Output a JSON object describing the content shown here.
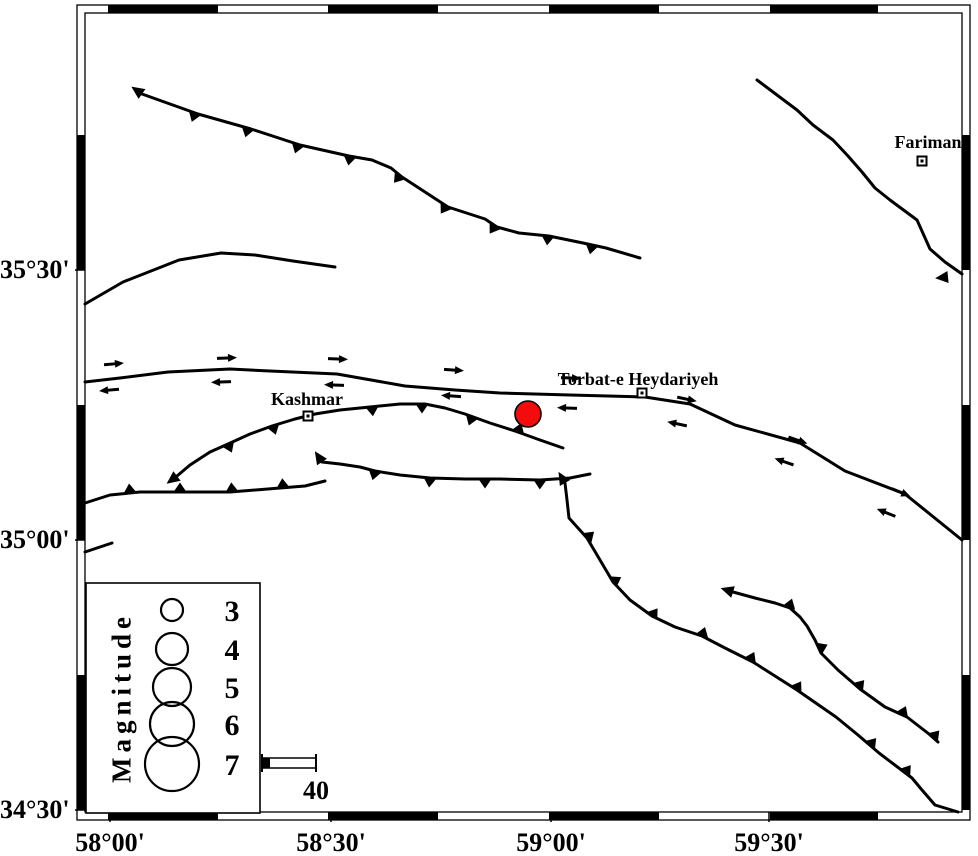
{
  "figure": {
    "type": "seismotectonic-map",
    "region": {
      "lon_min": "58°00'",
      "lon_max": "59°30'",
      "lat_min": "34°30'",
      "lat_max": "35°30'"
    }
  },
  "axes": {
    "lat": [
      {
        "text": "35°30'",
        "y": 270
      },
      {
        "text": "35°00'",
        "y": 540
      },
      {
        "text": "34°30'",
        "y": 810
      }
    ],
    "lon": [
      {
        "text": "58°00'",
        "x": 110
      },
      {
        "text": "58°30'",
        "x": 331
      },
      {
        "text": "59°00'",
        "x": 551
      },
      {
        "text": "59°30'",
        "x": 769
      }
    ]
  },
  "frame": {
    "inner": [
      85,
      13,
      962,
      812
    ],
    "outer": [
      77,
      5,
      970,
      820
    ],
    "black_x": [
      [
        108,
        218
      ],
      [
        328,
        438
      ],
      [
        549,
        659
      ],
      [
        770,
        878
      ]
    ],
    "black_y": [
      [
        135,
        270
      ],
      [
        405,
        540
      ],
      [
        675,
        810
      ]
    ],
    "line_color": "#000000"
  },
  "cities": [
    {
      "name": "Kashmar",
      "marker": [
        308,
        416
      ],
      "label_center": [
        307,
        399
      ]
    },
    {
      "name": "Torbat-e Heydariyeh",
      "marker": [
        642,
        393
      ],
      "label_center": [
        638,
        379
      ]
    },
    {
      "name": "Fariman",
      "marker": [
        922,
        161
      ],
      "label_center": [
        928,
        142
      ]
    }
  ],
  "earthquake": {
    "x": 528,
    "y": 414,
    "r": 13,
    "fill": "#f40b0b",
    "stroke": "#000000"
  },
  "faults": [
    {
      "name": "north-thrust-fault",
      "points": [
        [
          142,
          94
        ],
        [
          198,
          114
        ],
        [
          251,
          129
        ],
        [
          300,
          145
        ],
        [
          349,
          156
        ],
        [
          372,
          160
        ],
        [
          391,
          168
        ],
        [
          402,
          177
        ],
        [
          425,
          192
        ],
        [
          448,
          207
        ],
        [
          485,
          219
        ],
        [
          497,
          227
        ],
        [
          519,
          233
        ],
        [
          549,
          236
        ],
        [
          583,
          243
        ],
        [
          606,
          248
        ],
        [
          640,
          258
        ]
      ],
      "barbs": [
        {
          "x": 195,
          "side": -1
        },
        {
          "x": 248,
          "side": -1
        },
        {
          "x": 298,
          "side": -1
        },
        {
          "x": 350,
          "side": -1
        },
        {
          "x": 400,
          "side": -1
        },
        {
          "x": 446,
          "side": -1
        },
        {
          "x": 495,
          "side": -1
        },
        {
          "x": 548,
          "side": -1
        },
        {
          "x": 592,
          "side": -1
        }
      ],
      "tip": {
        "x": 142,
        "y": 94,
        "dx": -0.82,
        "dy": -0.57
      }
    },
    {
      "name": "north-curve-fault",
      "points": [
        [
          85,
          304
        ],
        [
          123,
          282
        ],
        [
          179,
          260
        ],
        [
          221,
          253
        ],
        [
          255,
          255
        ],
        [
          293,
          261
        ],
        [
          335,
          267
        ]
      ],
      "barbs": []
    },
    {
      "name": "northeast-fault",
      "points": [
        [
          757,
          80
        ],
        [
          777,
          95
        ],
        [
          797,
          110
        ],
        [
          813,
          125
        ],
        [
          833,
          140
        ],
        [
          848,
          156
        ],
        [
          862,
          172
        ],
        [
          875,
          188
        ],
        [
          890,
          200
        ],
        [
          917,
          220
        ],
        [
          930,
          249
        ],
        [
          945,
          262
        ],
        [
          962,
          274
        ]
      ],
      "barbs": [],
      "tip": {
        "x": 948,
        "y": 277,
        "dx": -0.99,
        "dy": 0.1
      }
    },
    {
      "name": "main-strike-slip-fault",
      "points": [
        [
          85,
          382
        ],
        [
          120,
          378
        ],
        [
          168,
          372
        ],
        [
          230,
          369
        ],
        [
          270,
          371
        ],
        [
          337,
          374
        ],
        [
          405,
          386
        ],
        [
          455,
          390
        ],
        [
          500,
          393
        ],
        [
          570,
          395
        ],
        [
          645,
          397
        ],
        [
          690,
          404
        ],
        [
          735,
          425
        ],
        [
          800,
          443
        ],
        [
          845,
          471
        ],
        [
          905,
          494
        ],
        [
          962,
          540
        ]
      ],
      "barbs": []
    },
    {
      "name": "kashmar-thrust-fault",
      "points": [
        [
          177,
          476
        ],
        [
          190,
          465
        ],
        [
          210,
          452
        ],
        [
          228,
          444
        ],
        [
          250,
          434
        ],
        [
          272,
          426
        ],
        [
          295,
          419
        ],
        [
          315,
          414
        ],
        [
          340,
          410
        ],
        [
          370,
          407
        ],
        [
          400,
          404
        ],
        [
          425,
          404
        ],
        [
          445,
          408
        ],
        [
          465,
          414
        ],
        [
          490,
          423
        ],
        [
          515,
          431
        ],
        [
          540,
          440
        ],
        [
          563,
          448
        ]
      ],
      "barbs": [
        {
          "x": 228,
          "side": -1
        },
        {
          "x": 273,
          "side": -1
        },
        {
          "x": 372,
          "side": -1
        },
        {
          "x": 422,
          "side": -1
        },
        {
          "x": 472,
          "side": -1
        },
        {
          "x": 518,
          "side": 1
        }
      ],
      "tip": {
        "x": 177,
        "y": 476,
        "dx": -0.8,
        "dy": 0.6
      }
    },
    {
      "name": "south-thrust-west",
      "points": [
        [
          85,
          503
        ],
        [
          110,
          495
        ],
        [
          140,
          492
        ],
        [
          180,
          492
        ],
        [
          230,
          492
        ],
        [
          280,
          488
        ],
        [
          305,
          486
        ],
        [
          325,
          481
        ]
      ],
      "barbs": [
        {
          "x": 130,
          "side": 1
        },
        {
          "x": 180,
          "side": 1
        },
        {
          "x": 232,
          "side": 1
        },
        {
          "x": 283,
          "side": 1
        }
      ]
    },
    {
      "name": "south-thrust-east",
      "points": [
        [
          322,
          462
        ],
        [
          340,
          464
        ],
        [
          360,
          467
        ],
        [
          375,
          471
        ],
        [
          400,
          475
        ],
        [
          430,
          478
        ],
        [
          465,
          479
        ],
        [
          500,
          479
        ],
        [
          540,
          480
        ],
        [
          570,
          478
        ],
        [
          590,
          474
        ]
      ],
      "barbs": [
        {
          "x": 375,
          "side": -1
        },
        {
          "x": 430,
          "side": -1
        },
        {
          "x": 485,
          "side": -1
        },
        {
          "x": 540,
          "side": -1
        }
      ],
      "tip": {
        "x": 322,
        "y": 462,
        "dx": -0.55,
        "dy": -0.83
      }
    },
    {
      "name": "se-thrust-long",
      "points": [
        [
          565,
          483
        ],
        [
          567,
          500
        ],
        [
          569,
          518
        ],
        [
          587,
          538
        ],
        [
          600,
          560
        ],
        [
          613,
          582
        ],
        [
          630,
          600
        ],
        [
          652,
          616
        ],
        [
          675,
          627
        ],
        [
          702,
          636
        ],
        [
          725,
          648
        ],
        [
          753,
          662
        ],
        [
          775,
          676
        ],
        [
          797,
          690
        ],
        [
          836,
          717
        ],
        [
          858,
          735
        ],
        [
          879,
          753
        ],
        [
          912,
          778
        ],
        [
          922,
          790
        ],
        [
          935,
          805
        ],
        [
          958,
          812
        ]
      ],
      "barbs": [
        {
          "x": 587,
          "side": 1
        },
        {
          "x": 613,
          "side": 1
        },
        {
          "x": 652,
          "side": 1
        },
        {
          "x": 702,
          "side": 1
        },
        {
          "x": 750,
          "side": 1
        },
        {
          "x": 796,
          "side": 1
        },
        {
          "x": 870,
          "side": 1
        },
        {
          "x": 905,
          "side": 1
        }
      ],
      "tip": {
        "x": 565,
        "y": 483,
        "dx": -0.5,
        "dy": -0.86
      }
    },
    {
      "name": "se-thrust-short",
      "points": [
        [
          733,
          592
        ],
        [
          755,
          598
        ],
        [
          775,
          603
        ],
        [
          790,
          608
        ],
        [
          800,
          617
        ],
        [
          807,
          626
        ],
        [
          815,
          640
        ],
        [
          821,
          653
        ],
        [
          838,
          670
        ],
        [
          860,
          689
        ],
        [
          885,
          707
        ],
        [
          907,
          717
        ],
        [
          929,
          734
        ],
        [
          938,
          742
        ]
      ],
      "barbs": [
        {
          "x": 789,
          "side": 1
        },
        {
          "x": 819,
          "side": 1
        },
        {
          "x": 858,
          "side": 1
        },
        {
          "x": 902,
          "side": 1
        },
        {
          "x": 933,
          "side": 1
        }
      ],
      "tip": {
        "x": 733,
        "y": 592,
        "dx": -0.95,
        "dy": -0.3
      }
    },
    {
      "name": "left-short-segment",
      "points": [
        [
          85,
          552
        ],
        [
          112,
          543
        ]
      ],
      "barbs": []
    }
  ],
  "strike_slip_arrows": [
    {
      "xu": 113,
      "yu": 364,
      "xl": 110,
      "yl": 390,
      "tilt": -5
    },
    {
      "xu": 226,
      "yu": 358,
      "xl": 222,
      "yl": 382,
      "tilt": -2
    },
    {
      "xu": 337,
      "yu": 359,
      "xl": 335,
      "yl": 385,
      "tilt": 2
    },
    {
      "xu": 453,
      "yu": 370,
      "xl": 452,
      "yl": 396,
      "tilt": 4
    },
    {
      "xu": 570,
      "yu": 378,
      "xl": 568,
      "yl": 408,
      "tilt": 2
    },
    {
      "xu": 686,
      "yu": 399,
      "xl": 678,
      "yl": 424,
      "tilt": 12
    },
    {
      "xu": 797,
      "yu": 440,
      "xl": 785,
      "yl": 462,
      "tilt": 19
    },
    {
      "xu": 900,
      "yu": 492,
      "xl": 887,
      "yl": 513,
      "tilt": 22
    }
  ],
  "legend": {
    "title": "Magnitude",
    "box": [
      86,
      583,
      174,
      230
    ],
    "circle_cx": 172,
    "entries": [
      {
        "label": "3",
        "cy": 610,
        "r": 11
      },
      {
        "label": "4",
        "cy": 649,
        "r": 16
      },
      {
        "label": "5",
        "cy": 687,
        "r": 19
      },
      {
        "label": "6",
        "cy": 724,
        "r": 22
      },
      {
        "label": "7",
        "cy": 764,
        "r": 27
      }
    ]
  },
  "scalebar": {
    "label": "40",
    "x1": 262,
    "x2": 316,
    "y1": 758,
    "y2": 768,
    "fill_to": 270
  }
}
